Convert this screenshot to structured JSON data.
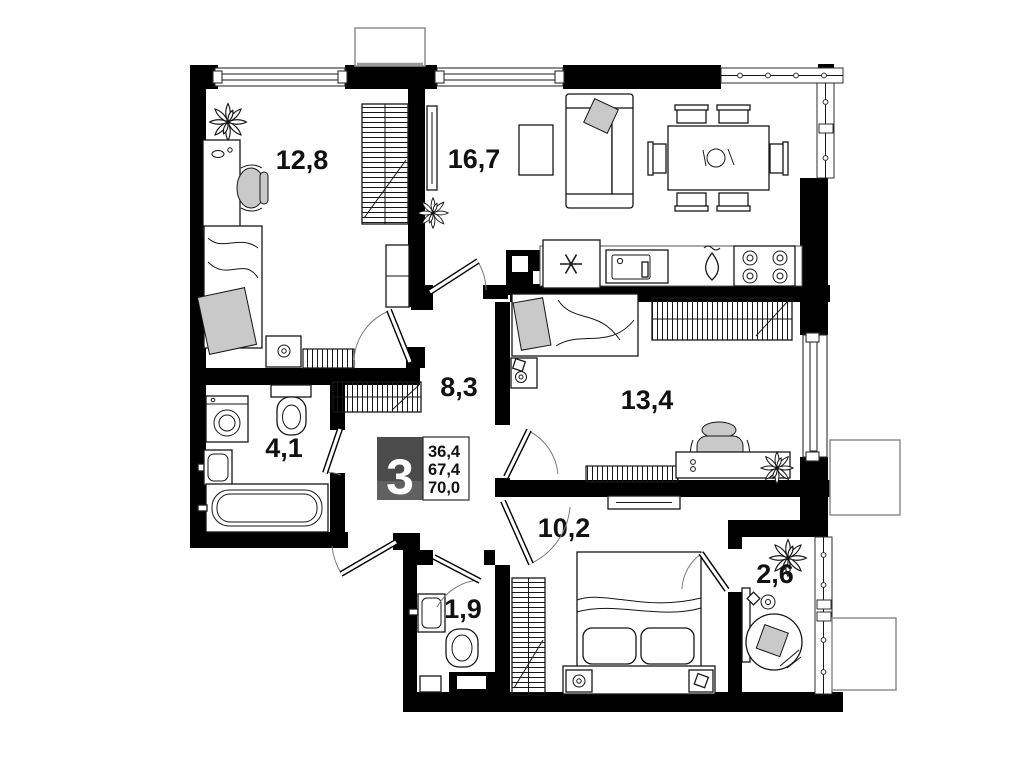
{
  "rooms": {
    "bedroom1": {
      "label": "12,8"
    },
    "living": {
      "label": "16,7"
    },
    "hallway": {
      "label": "8,3"
    },
    "bedroom2": {
      "label": "13,4"
    },
    "bathroom": {
      "label": "4,1"
    },
    "bedroom3": {
      "label": "10,2"
    },
    "wc": {
      "label": "1,9"
    },
    "balcony": {
      "label": "2,6"
    }
  },
  "badge": {
    "rooms_count": "3",
    "values": [
      "36,4",
      "67,4",
      "70,0"
    ]
  },
  "colors": {
    "wall": "#000000",
    "badge_dark": "#4b4b4b",
    "badge_light": "#616161",
    "furniture_accent": "#c9c9c9"
  }
}
